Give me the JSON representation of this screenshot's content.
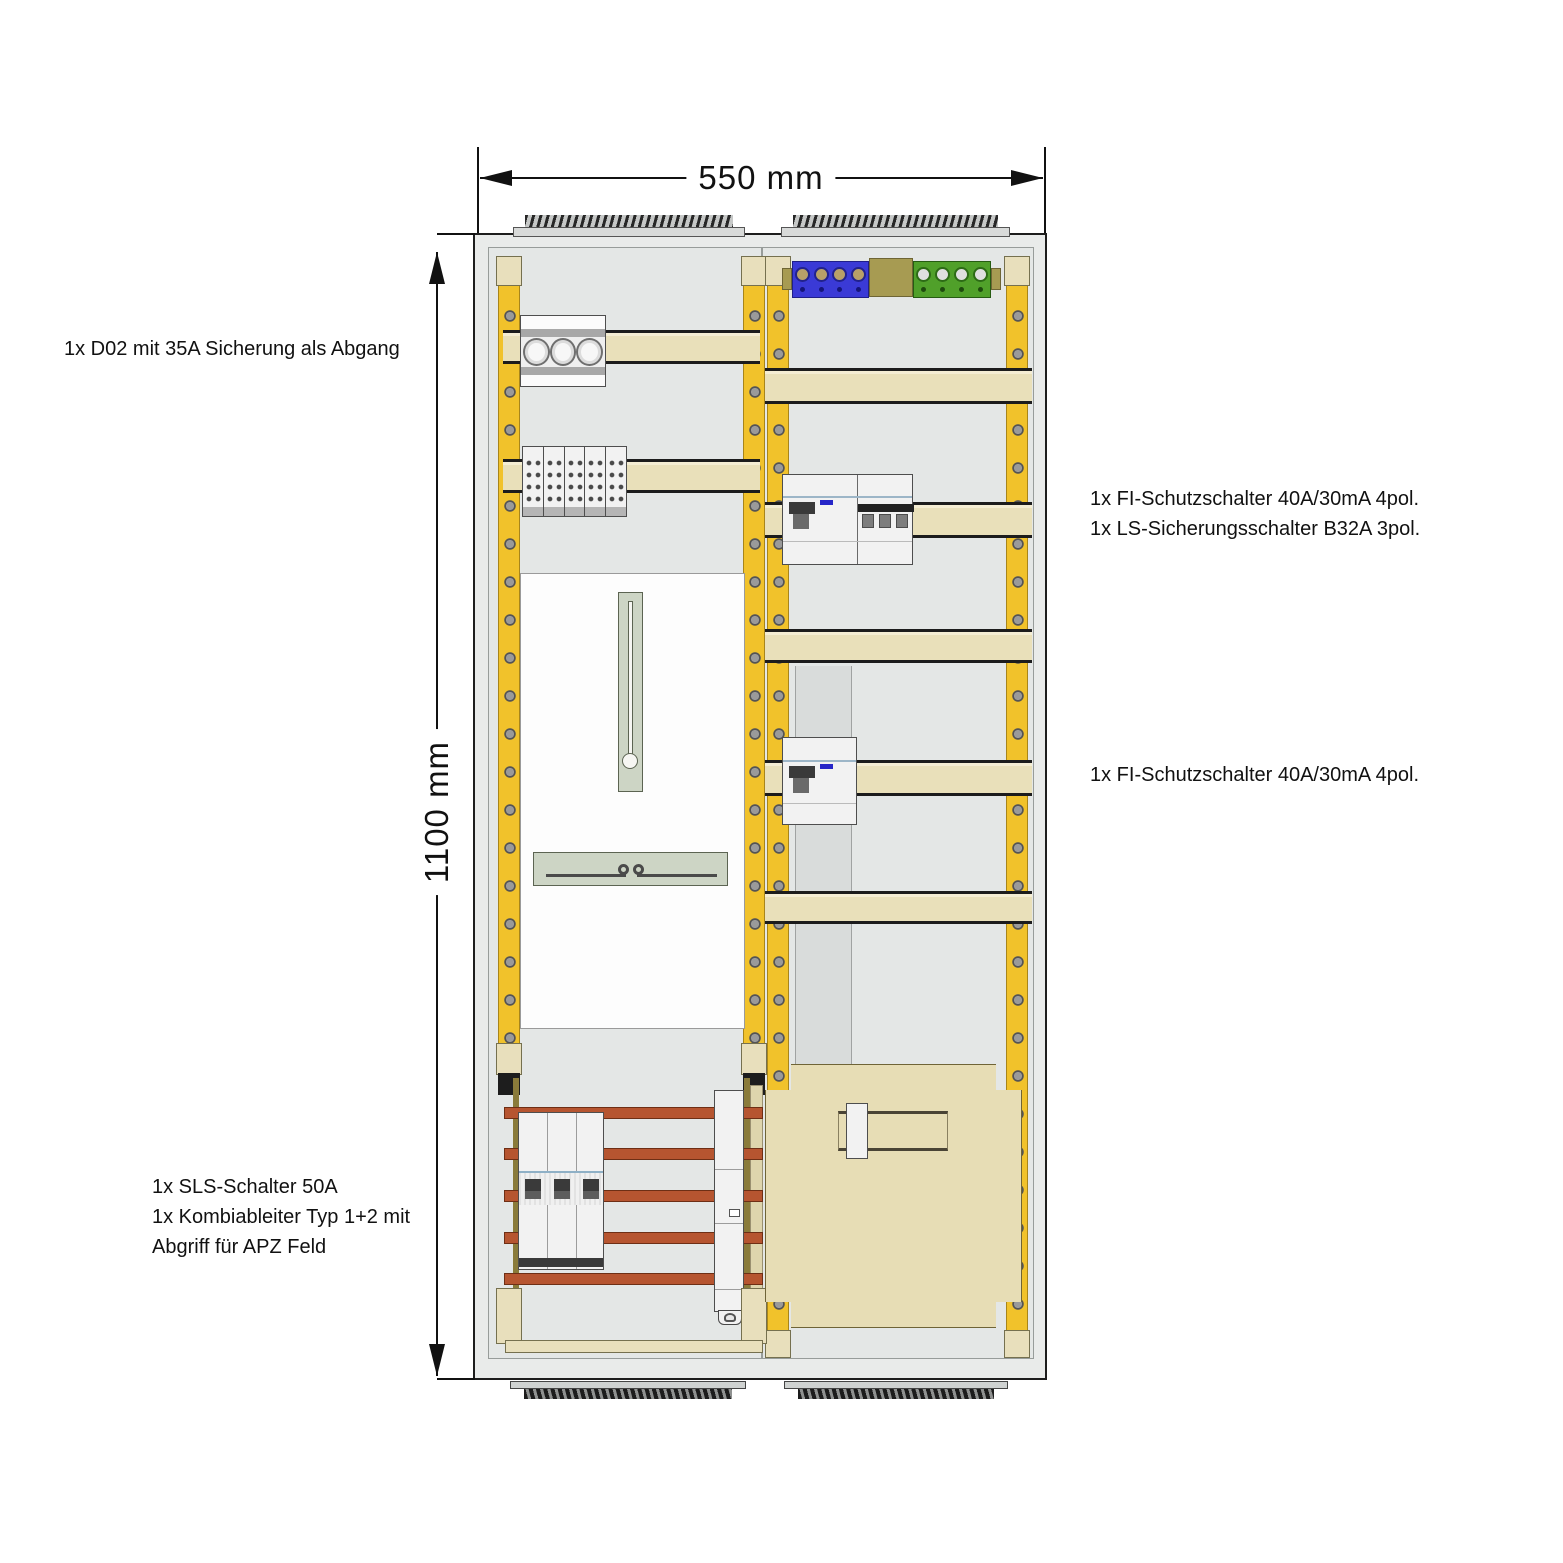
{
  "diagram": {
    "kind": "meter-cabinet-layout-drawing",
    "dimension_width": "550 mm",
    "dimension_height": "1100 mm",
    "annotations": {
      "d02": "1x D02 mit 35A Sicherung als Abgang",
      "fi_ls": [
        "1x FI-Schutzschalter 40A/30mA 4pol.",
        "1x LS-Sicherungsschalter B32A 3pol."
      ],
      "fi": "1x FI-Schutzschalter 40A/30mA 4pol.",
      "sls": [
        "1x SLS-Schalter 50A",
        "1x Kombiableiter Typ 1+2 mit",
        "Abgriff für APZ Feld"
      ]
    },
    "colors": {
      "rail_yellow": "#F1C22B",
      "din_rail_beige": "#E9E0BA",
      "bracket_beige": "#E8DFBC",
      "busbar_copper": "#B65530",
      "terminal_blue": "#3A3AD6",
      "terminal_green": "#50A02A",
      "block_khaki": "#A79B52",
      "apz_cover_beige": "#E7DDB5",
      "meter_plate_white": "#FDFDFD",
      "fitting_sage": "#CDD5C5",
      "cabinet_grey": "#E9EBEA",
      "device_white": "#F2F2F2"
    }
  }
}
